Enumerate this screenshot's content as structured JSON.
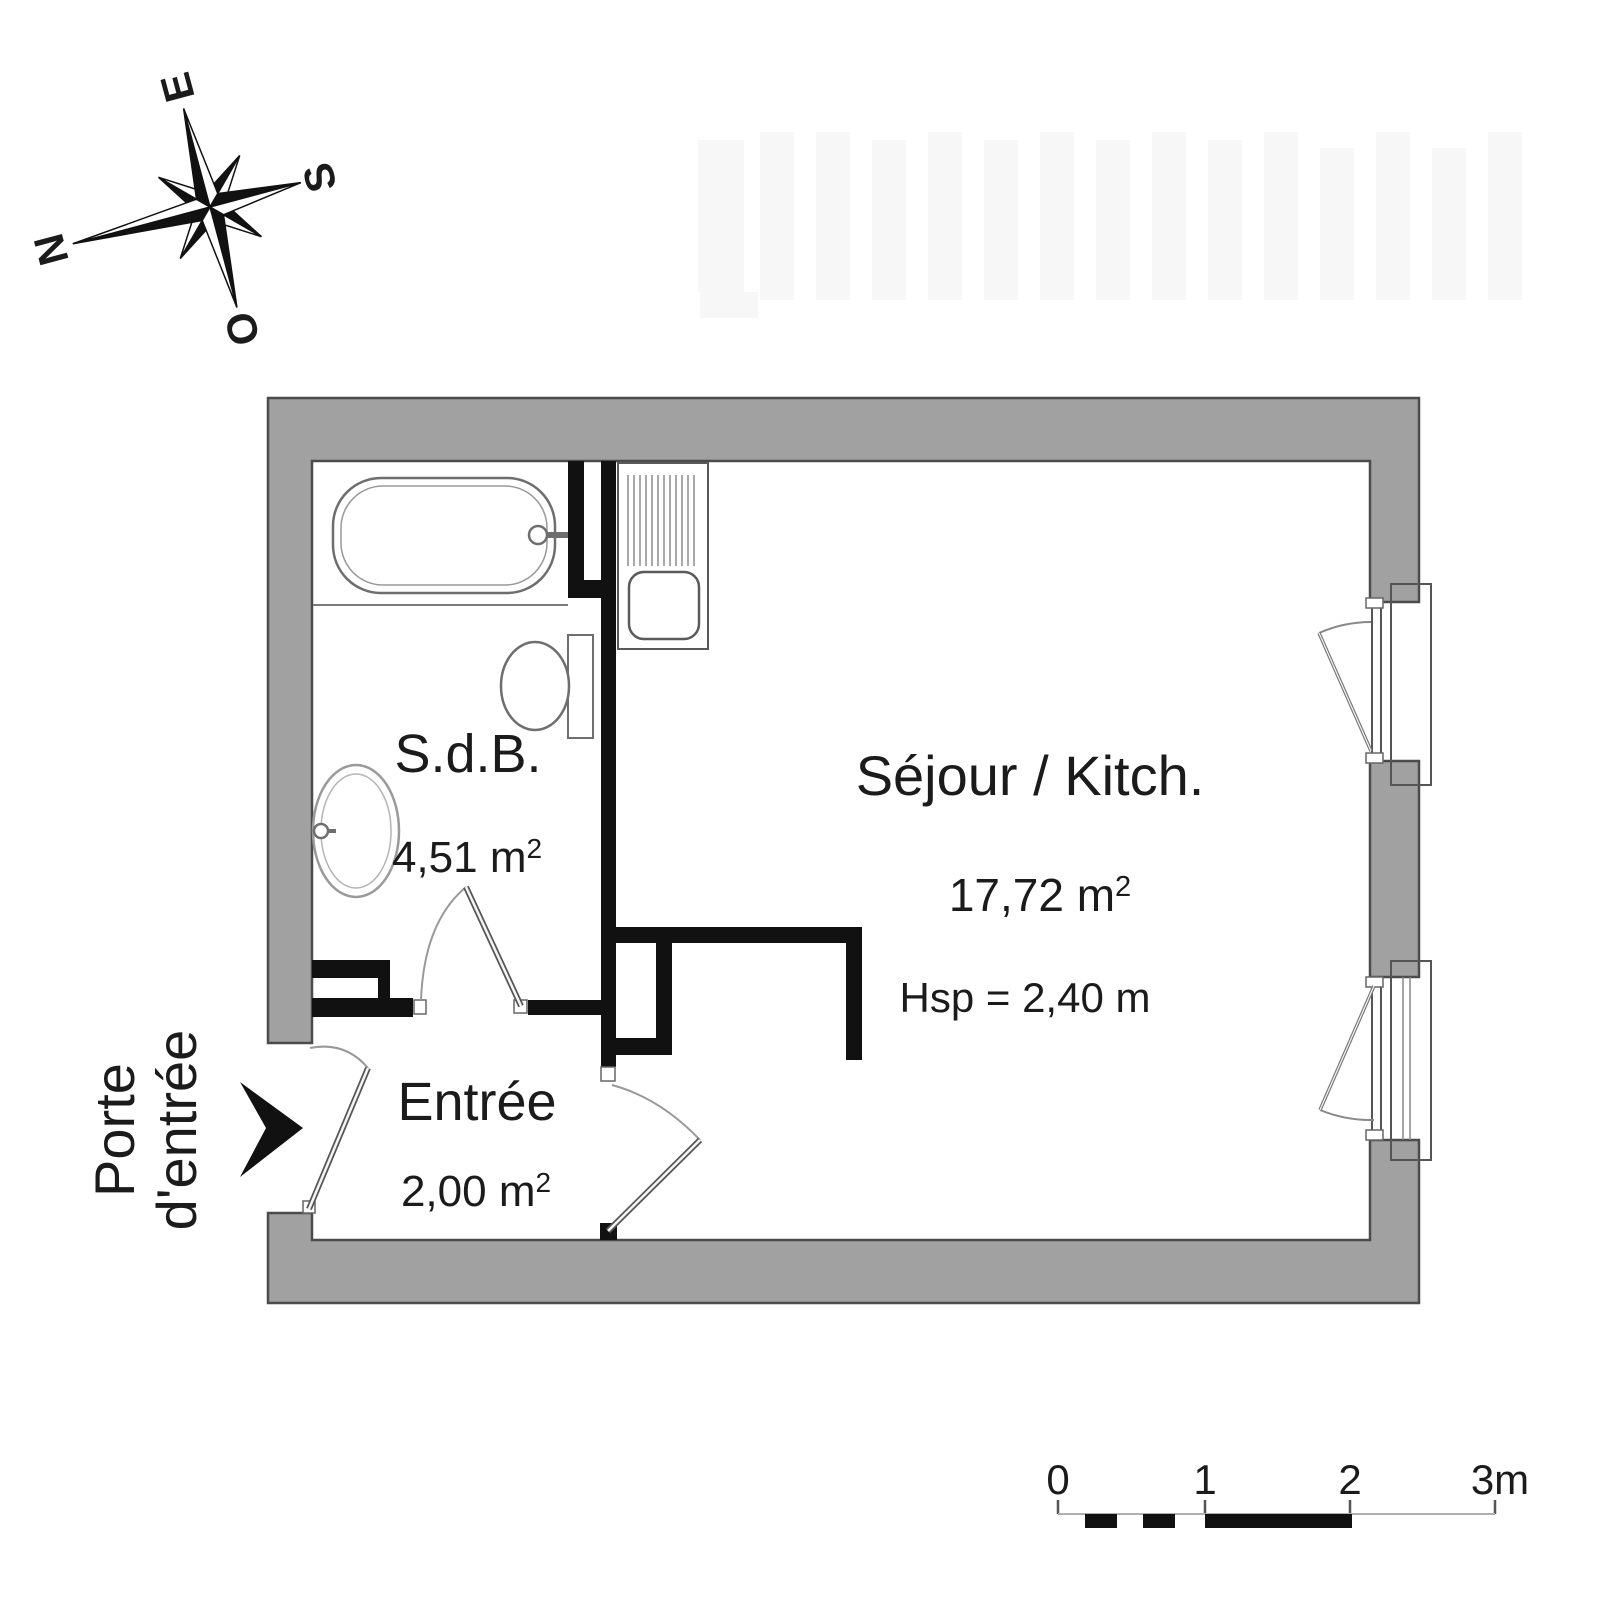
{
  "compass": {
    "n": "N",
    "e": "E",
    "s": "S",
    "o": "O"
  },
  "rooms": {
    "bathroom": {
      "name": "S.d.B.",
      "area": "4,51 m",
      "area_sup": "2"
    },
    "living": {
      "name": "Séjour / Kitch.",
      "area": "17,72 m",
      "area_sup": "2",
      "ceiling": "Hsp = 2,40 m"
    },
    "entry": {
      "name": "Entrée",
      "area": "2,00 m",
      "area_sup": "2"
    }
  },
  "annotations": {
    "front_door_line1": "Porte",
    "front_door_line2": "d'entrée"
  },
  "scale_bar": {
    "t0": "0",
    "t1": "1",
    "t2": "2",
    "t3": "3m"
  },
  "colors": {
    "wall_fill": "#a1a1a1",
    "wall_outline": "#4b4b4b",
    "partition": "#111111",
    "text": "#1b1b1b"
  }
}
